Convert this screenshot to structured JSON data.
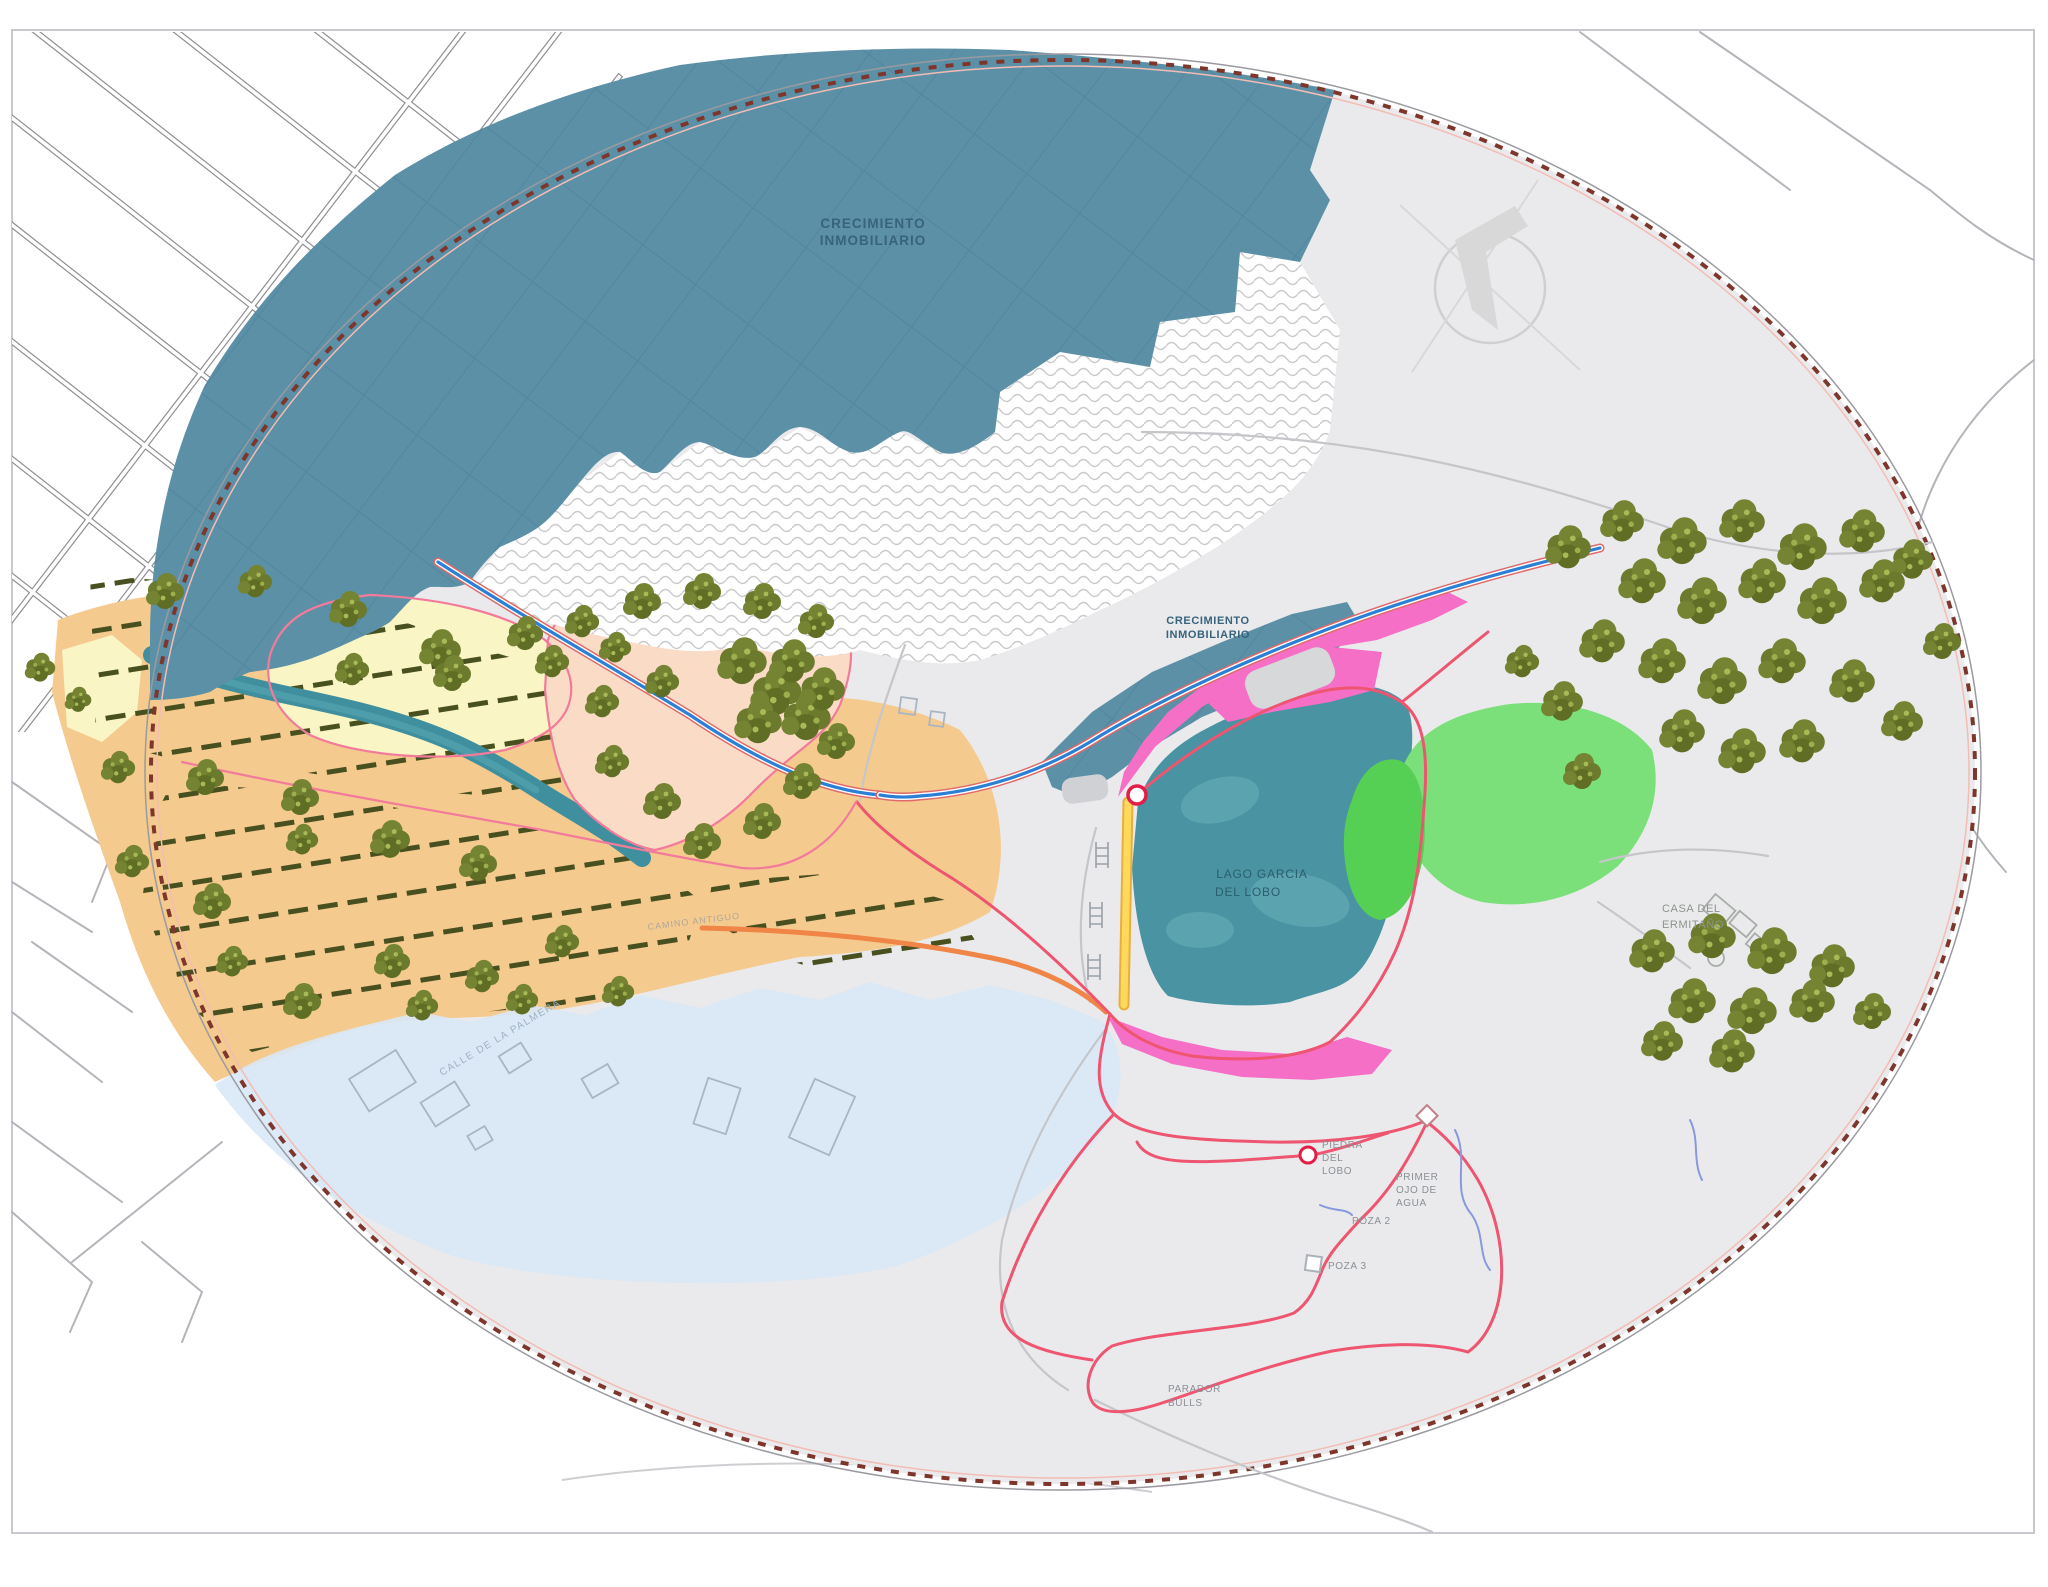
{
  "map": {
    "labels": {
      "growth_top": [
        "CRECIMIENTO",
        "INMOBILIARIO"
      ],
      "growth_mid": [
        "CRECIMIENTO",
        "INMOBILIARIO"
      ],
      "lake": [
        "LAGO GARCIA",
        "DEL LOBO"
      ],
      "hermit_house": [
        "CASA DEL",
        "ERMITAÑO"
      ],
      "wolf_rock": [
        "PIEDRA",
        "DEL",
        "LOBO"
      ],
      "first_water_eye": [
        "PRIMER",
        "OJO DE",
        "AGUA"
      ],
      "pool_2": "POZA 2",
      "pool_3": "POZA 3",
      "parador": [
        "PARADOR",
        "BULLS"
      ],
      "street_palmera": "CALLE DE LA PALMERA",
      "old_path": "CAMINO ANTIGUO"
    },
    "colors": {
      "urban_blue": "#5C90A7",
      "urban_streets": "#4A7F98",
      "lake_teal": "#4A93A2",
      "farmland_orange": "#F4CA8F",
      "field_yellow": "#FAF5C5",
      "orchard_salmon": "#FADCC6",
      "wetland_pink": "#F66FC7",
      "meadow_green": "#7CE07A",
      "meadow_green_dark": "#55D055",
      "zone_lightblue": "#D9E8F6",
      "study_area_gray": "#EAEAEC",
      "boundary_red": "#7E352C",
      "trail_red": "#EE5570",
      "river_blue": "#2B7FD4",
      "road_yellow": "#FFD84D",
      "tree_olive": "#6B7A2C"
    }
  }
}
